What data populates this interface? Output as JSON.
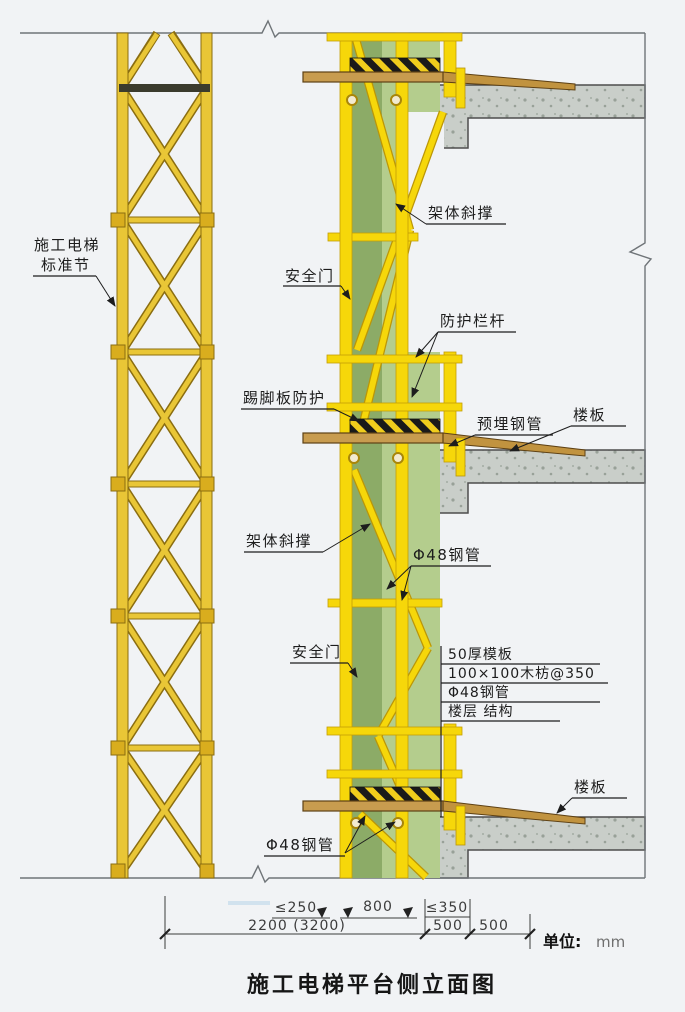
{
  "drawing": {
    "title": "施工电梯平台侧立面图",
    "unit_label": "单位:",
    "unit_value": "mm"
  },
  "labels": {
    "tower_line1": "施工电梯",
    "tower_line2": "标准节",
    "safety_door_top": "安全门",
    "frame_brace_top": "架体斜撑",
    "guard_rail": "防护栏杆",
    "toe_board_guard": "踢脚板防护",
    "embedded_steel_pipe": "预埋钢管",
    "floor_slab_mid": "楼板",
    "frame_brace_mid": "架体斜撑",
    "steel_pipe_48_mid": "Φ48钢管",
    "safety_door_bottom": "安全门",
    "floor_slab_bottom": "楼板",
    "steel_pipe_48_bottom": "Φ48钢管",
    "detail_notes": [
      "50厚模板",
      "100×100木枋@350",
      "Φ48钢管",
      "楼层 结构"
    ]
  },
  "dimensions": {
    "row1": [
      "≤250",
      "800",
      "≤350"
    ],
    "row2": [
      "2200 (3200)",
      "500",
      "500"
    ]
  },
  "colors": {
    "scaffold_yellow": "#f6d70a",
    "tower_yellow": "#e9c636",
    "mesh_green_light": "#b4cd8d",
    "mesh_green_dark": "#8cab67",
    "concrete_gray": "#c9cec9",
    "wood_brown": "#c89c4f",
    "hazard_black": "#1a1a1a",
    "background": "#f1f3f5"
  }
}
